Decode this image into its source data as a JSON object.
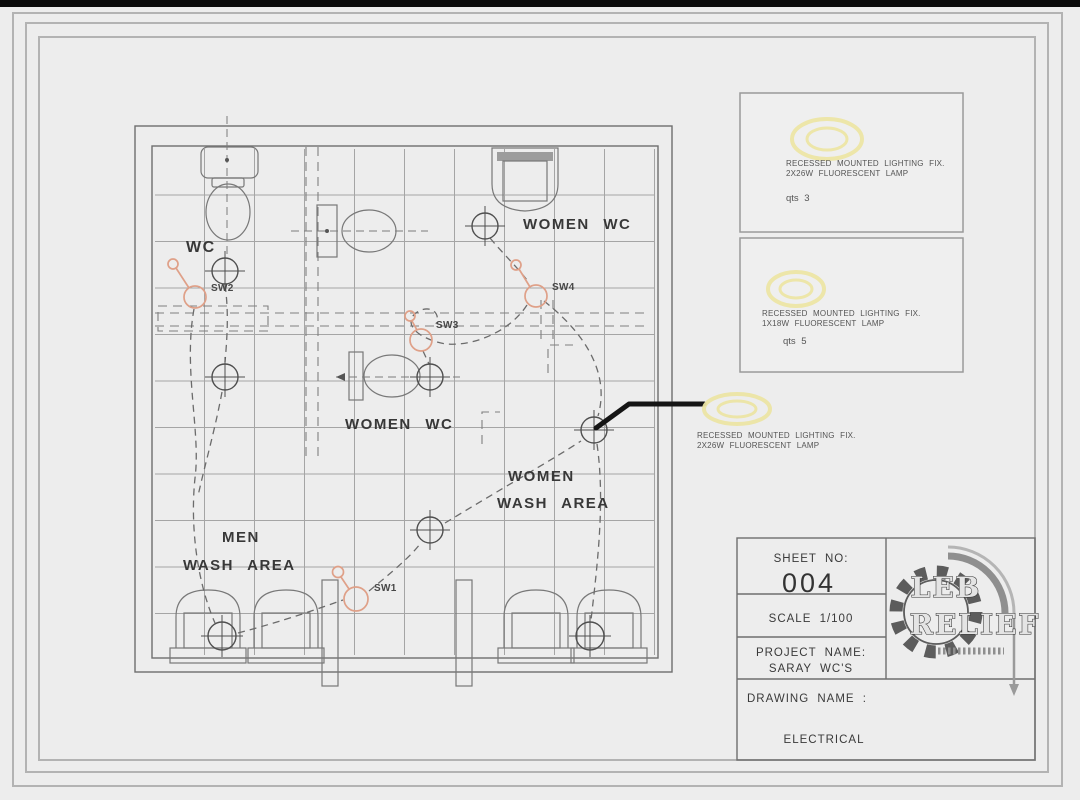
{
  "colors": {
    "background": "#ededed",
    "line_gray": "#6e6e6e",
    "switch_orange": "#dfa088",
    "lamp_yellow": "#ece5a4",
    "leader_black": "#151515"
  },
  "plan": {
    "labels": {
      "wc": "WC",
      "women_wc_top": "WOMEN WC",
      "women_wc_mid": "WOMEN WC",
      "women_wash_1": "WOMEN",
      "women_wash_2": "WASH AREA",
      "men_wash_1": "MEN",
      "men_wash_2": "WASH AREA",
      "sw1": "SW1",
      "sw2": "SW2",
      "sw3": "SW3",
      "sw4": "SW4"
    }
  },
  "legend": [
    {
      "line1": "RECESSED MOUNTED LIGHTING FIX.",
      "line2": "2X26W FLUORESCENT LAMP",
      "qty": "qts 3"
    },
    {
      "line1": "RECESSED MOUNTED LIGHTING FIX.",
      "line2": "1X18W FLUORESCENT LAMP",
      "qty": "qts 5"
    }
  ],
  "callout": {
    "line1": "RECESSED MOUNTED LIGHTING FIX.",
    "line2": "2X26W FLUORESCENT LAMP"
  },
  "title_block": {
    "sheet_label": "SHEET NO:",
    "sheet_no": "004",
    "scale": "SCALE 1/100",
    "project_label": "PROJECT NAME:",
    "project_name": "SARAY WC'S",
    "drawing_label": "DRAWING NAME :",
    "drawing_name": "ELECTRICAL",
    "logo_top": "LEB",
    "logo_bottom": "RELIEF"
  }
}
